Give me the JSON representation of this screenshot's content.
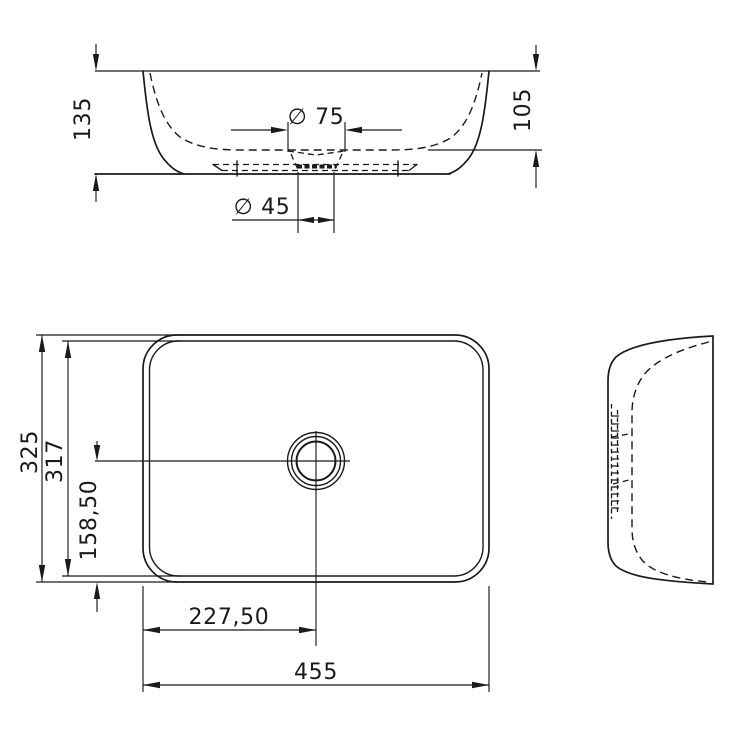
{
  "drawing": {
    "type": "technical-dimension-drawing",
    "subject": "rectangular countertop washbasin",
    "background_color": "#ffffff",
    "line_color": "#1a1a1a",
    "views": {
      "front": {
        "label": "front-elevation",
        "dims": {
          "overall_height": "135",
          "bowl_depth": "105",
          "recess_diameter": "∅ 75",
          "drain_diameter": "∅ 45"
        }
      },
      "plan": {
        "label": "top-view",
        "dims": {
          "overall_depth": "325",
          "inner_depth": "317",
          "drain_center_from_front": "158,50",
          "drain_center_from_left": "227,50",
          "overall_width": "455"
        }
      },
      "side": {
        "label": "side-elevation"
      }
    }
  }
}
